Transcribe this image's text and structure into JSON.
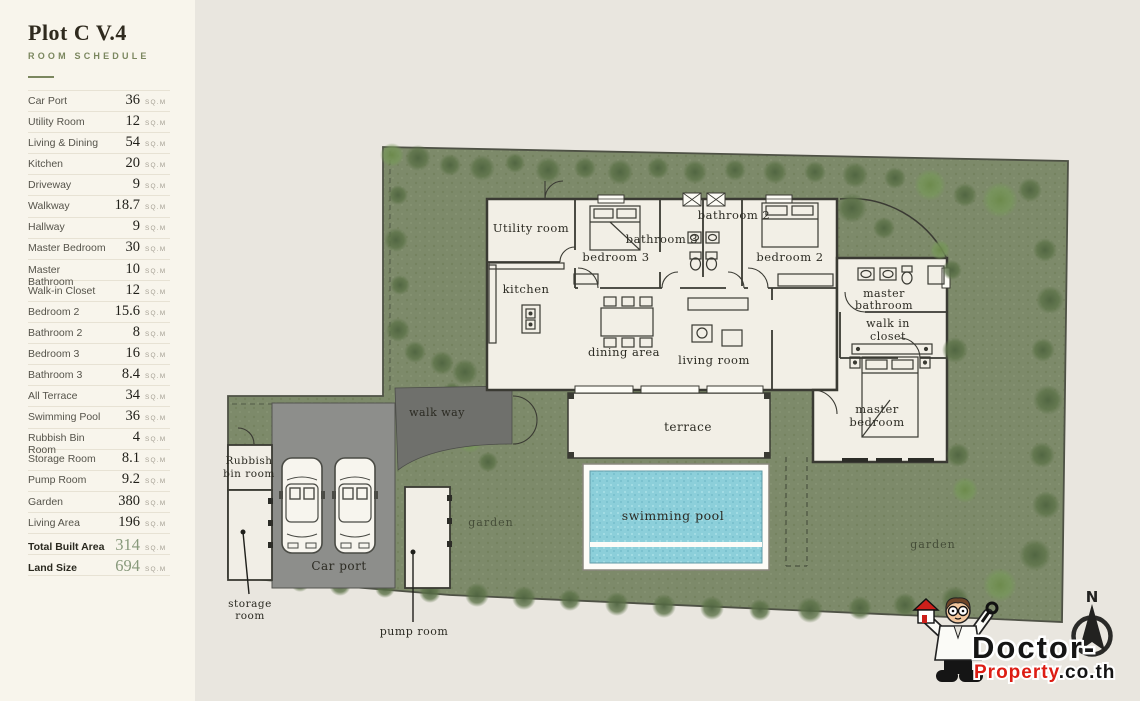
{
  "sidebar": {
    "title": "Plot C V.4",
    "subtitle": "ROOM SCHEDULE",
    "unit": "SQ.M",
    "rows": [
      {
        "label": "Car Port",
        "value": "36",
        "emphasis": false
      },
      {
        "label": "Utility Room",
        "value": "12",
        "emphasis": false
      },
      {
        "label": "Living & Dining",
        "value": "54",
        "emphasis": false
      },
      {
        "label": "Kitchen",
        "value": "20",
        "emphasis": false
      },
      {
        "label": "Driveway",
        "value": "9",
        "emphasis": false
      },
      {
        "label": "Walkway",
        "value": "18.7",
        "emphasis": false
      },
      {
        "label": "Hallway",
        "value": "9",
        "emphasis": false
      },
      {
        "label": "Master Bedroom",
        "value": "30",
        "emphasis": false
      },
      {
        "label": "Master Bathroom",
        "value": "10",
        "emphasis": false
      },
      {
        "label": "Walk-in Closet",
        "value": "12",
        "emphasis": false
      },
      {
        "label": "Bedroom 2",
        "value": "15.6",
        "emphasis": false
      },
      {
        "label": "Bathroom 2",
        "value": "8",
        "emphasis": false
      },
      {
        "label": "Bedroom 3",
        "value": "16",
        "emphasis": false
      },
      {
        "label": "Bathroom 3",
        "value": "8.4",
        "emphasis": false
      },
      {
        "label": "All Terrace",
        "value": "34",
        "emphasis": false
      },
      {
        "label": "Swimming Pool",
        "value": "36",
        "emphasis": false
      },
      {
        "label": "Rubbish Bin Room",
        "value": "4",
        "emphasis": false
      },
      {
        "label": "Storage Room",
        "value": "8.1",
        "emphasis": false
      },
      {
        "label": "Pump Room",
        "value": "9.2",
        "emphasis": false
      },
      {
        "label": "Garden",
        "value": "380",
        "emphasis": false
      },
      {
        "label": "Living Area",
        "value": "196",
        "emphasis": false
      },
      {
        "label": "Total Built Area",
        "value": "314",
        "emphasis": true
      },
      {
        "label": "Land Size",
        "value": "694",
        "emphasis": true
      }
    ]
  },
  "plan": {
    "labels": {
      "utility_room": "Utility room",
      "kitchen": "kitchen",
      "bedroom_3": "bedroom 3",
      "bathroom_3": "bathroom 3",
      "bathroom_2": "bathroom 2",
      "bedroom_2": "bedroom 2",
      "master_bathroom": [
        "master",
        "bathroom"
      ],
      "walk_in_closet": [
        "walk in",
        "closet"
      ],
      "living_room": "living room",
      "dining_area": "dining area",
      "terrace": "terrace",
      "master_bedroom": [
        "master",
        "bedroom"
      ],
      "swimming_pool": "swimming pool",
      "walk_way": "walk way",
      "car_port": "Car port",
      "rubbish_bin_room": [
        "Rubbish",
        "bin room"
      ],
      "storage_room": [
        "storage",
        "room"
      ],
      "pump_room": "pump room",
      "garden_left": "garden",
      "garden_right": "garden"
    },
    "compass_north": "N",
    "logo": {
      "word_black": "Doctor-",
      "word_red": "Property",
      "word_suffix": ".co.th"
    }
  },
  "colors": {
    "accent_green": "#7b875f",
    "value_green": "#87997b",
    "land_green": "#7d8a6a",
    "pool_blue": "#8ccfda",
    "walkway_gray": "#6f706c",
    "carport_gray": "#8d8e8b",
    "logo_red": "#dd1d14",
    "sidebar_bg": "#f8f5ec",
    "canvas_bg": "#e9e6df"
  }
}
